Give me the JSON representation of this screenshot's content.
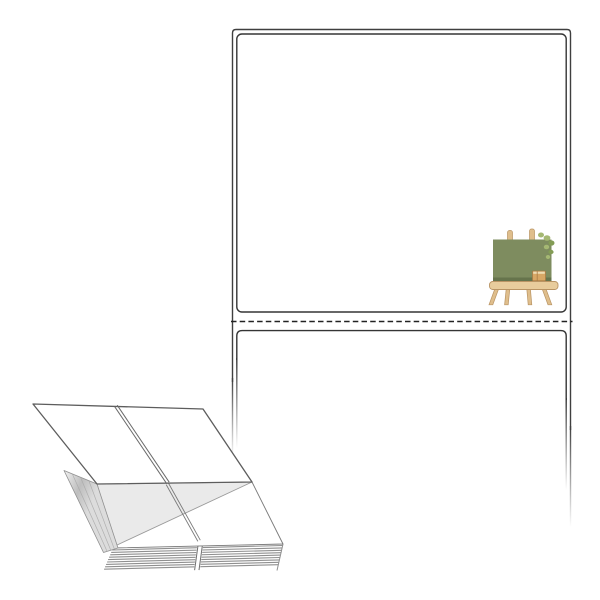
{
  "image": {
    "width": 600,
    "height": 600,
    "subject": "fanfold-label-product-illustration"
  },
  "palette": {
    "background": "#FFFFFF",
    "sheet_outline": "#3F3F3F",
    "label_border": "#353535",
    "perforation_dash": "#222222",
    "illustration_line": "#5D5D5D",
    "stack_stripe": "#8F8F8F",
    "stack_edge": "#707070",
    "folded_sheet_fill": "#EAEAEA",
    "spine_light": "#F2F2F2",
    "spine_mid": "#BEBEBE",
    "spine_end": "#DCDCDC",
    "board_green": "#7E8C5F",
    "board_green_dark": "#66744C",
    "wood_light": "#E8CC9C",
    "wood_mid": "#DFBE8C",
    "wood_outline": "#B99464",
    "box_tan": "#D8A765",
    "box_dark": "#A97C45",
    "box_top": "#EFDDB4",
    "leaf_light": "#A5B873",
    "leaf_dark": "#839C55"
  },
  "sheet": {
    "dash_pattern": "5.5 3.2",
    "label_corner_radius": 5,
    "labels_visible": 2
  },
  "stack": {
    "front_stripe_count": 9,
    "spine_layer_lines": 3
  }
}
